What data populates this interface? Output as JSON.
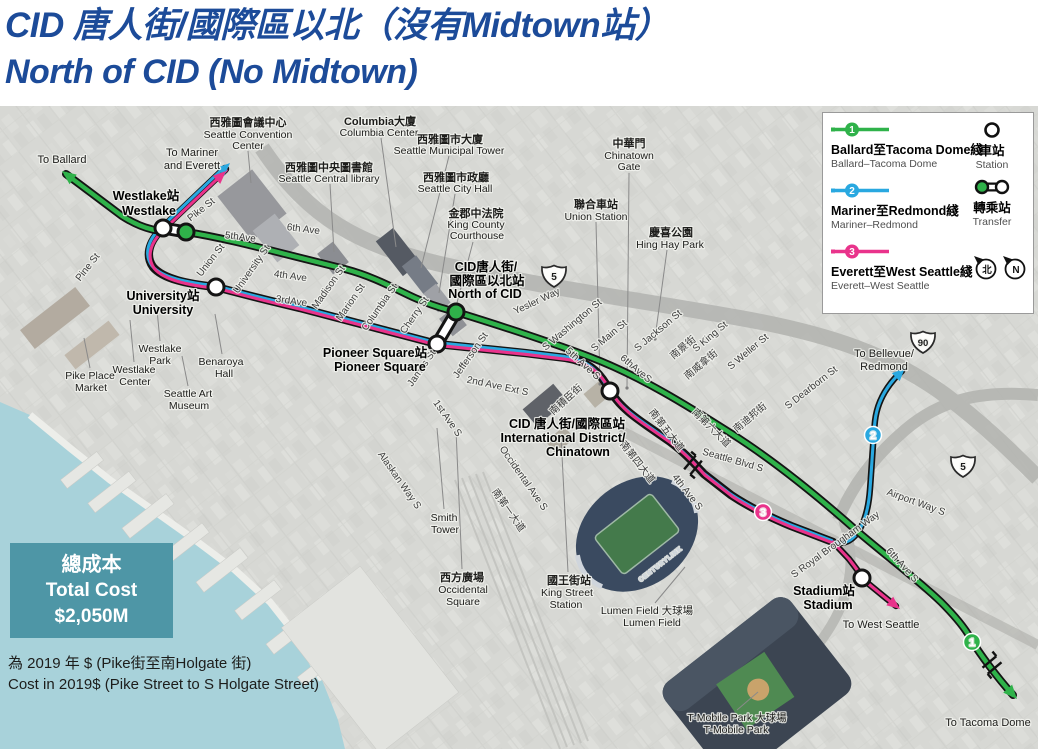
{
  "title": {
    "zh": "CID 唐人街/國際區以北（沒有Midtown站）",
    "en": "North of CID (No Midtown)"
  },
  "colors": {
    "green": "#2fb24a",
    "blue": "#29a8e0",
    "pink": "#e9338b",
    "title_blue": "#1c4b99",
    "cost_teal": "#4e96a6"
  },
  "legend": {
    "lines": [
      {
        "badge": "1",
        "zh": "Ballard至Tacoma Dome綫",
        "en": "Ballard–Tacoma Dome",
        "color": "#2fb24a"
      },
      {
        "badge": "2",
        "zh": "Mariner至Redmond綫",
        "en": "Mariner–Redmond",
        "color": "#29a8e0"
      },
      {
        "badge": "3",
        "zh": "Everett至West Seattle綫",
        "en": "Everett–West Seattle",
        "color": "#e9338b"
      }
    ],
    "station_zh": "車站",
    "station_en": "Station",
    "transfer_zh": "轉乘站",
    "transfer_en": "Transfer",
    "compass_zh": "北",
    "compass_en": "N"
  },
  "cost": {
    "zh": "總成本",
    "en": "Total Cost",
    "value": "$2,050M"
  },
  "footnote": {
    "zh": "為 2019 年 $ (Pike街至南Holgate 街)",
    "en": "Cost in 2019$ (Pike Street to S Holgate Street)"
  },
  "map": {
    "destinations": {
      "ballard": "To Ballard",
      "mariner1": "To Mariner",
      "mariner2": "and Everett",
      "bellevue1": "To Bellevue/",
      "bellevue2": "Redmond",
      "west_seattle": "To West Seattle",
      "tacoma": "To Tacoma Dome"
    },
    "stations": {
      "westlake_zh": "Westlake站",
      "westlake_en": "Westlake",
      "university_zh": "University站",
      "university_en": "University",
      "north_cid_1": "CID唐人街/",
      "north_cid_2": "國際區以北站",
      "north_cid_3": "North of CID",
      "pioneer_zh": "Pioneer Square站",
      "pioneer_en": "Pioneer Square",
      "cid_1": "CID 唐人街/國際區站",
      "cid_2": "International District/",
      "cid_3": "Chinatown",
      "stadium_zh": "Stadium站",
      "stadium_en": "Stadium"
    },
    "places": {
      "conv1": "西雅圖會議中心",
      "conv2": "Seattle Convention",
      "conv3": "Center",
      "lib1": "西雅圖中央圖書館",
      "lib2": "Seattle Central library",
      "col1": "Columbia大廈",
      "col2": "Columbia Center",
      "mun1": "西雅圖市大廈",
      "mun2": "Seattle Municipal Tower",
      "hall1": "西雅圖市政廳",
      "hall2": "Seattle City Hall",
      "court1": "金郡中法院",
      "court2": "King County",
      "court3": "Courthouse",
      "gate1": "中華門",
      "gate2": "Chinatown",
      "gate3": "Gate",
      "union1": "聯合車站",
      "union2": "Union Station",
      "hing1": "慶喜公園",
      "hing2": "Hing Hay Park",
      "wpark1": "Westlake",
      "wpark2": "Park",
      "ben1": "Benaroya",
      "ben2": "Hall",
      "pike1": "Pike Place",
      "pike2": "Market",
      "wcen1": "Westlake",
      "wcen2": "Center",
      "sam1": "Seattle Art",
      "sam2": "Museum",
      "smith1": "Smith",
      "smith2": "Tower",
      "occ1": "西方廣場",
      "occ2": "Occidental",
      "occ3": "Square",
      "king1": "國王街站",
      "king2": "King Street",
      "king3": "Station",
      "lumen1": "Lumen Field 大球場",
      "lumen2": "Lumen Field",
      "tmob1": "T-Mobile Park 大球場",
      "tmob2": "T-Mobile Park"
    },
    "streets": {
      "pike": "Pike St",
      "pine": "Pine St",
      "union_st": "Union St",
      "univ": "University St",
      "ave5": "5thAve",
      "ave6": "6th Ave",
      "ave4": "4th Ave",
      "ave3": "3rdAve",
      "madison": "Madison St",
      "marion": "Marion St",
      "columbia": "Columbia St",
      "cherry": "Cherry St",
      "james": "James St",
      "jefferson": "Jefferson St",
      "ave1s": "1st Ave S",
      "ave2ext": "2nd Ave Ext S",
      "yesler": "Yesler Way",
      "swash": "S Washington St",
      "smain": "S Main St",
      "sjackson": "S Jackson St",
      "sjackson_zh": "南積臣街",
      "sking": "S King St",
      "sking_zh": "南景街",
      "sweller": "S Weller St",
      "sweller_zh": "南威拿街",
      "sdearborn": "S Dearborn St",
      "sdearborn_zh": "南迪邦街",
      "ave6s_zh": "南第六大道",
      "ave6s_line": "6thAveS",
      "ave5s": "5th Ave S",
      "ave5s_zh": "南第五大道",
      "ave4s_zh": "南第四大道",
      "ave4s": "4th Ave S",
      "seattle_blvd": "Seattle Blvd S",
      "occidental": "Occidental Ave S",
      "ave1s_zh": "南第一大道",
      "alaskan": "Alaskan Way S",
      "royal": "S Royal Brougham Way",
      "ave6s2": "6th Ave S",
      "airport": "Airport Way S"
    },
    "badges": {
      "b1": "1",
      "b2": "2",
      "b3": "3"
    },
    "shields": {
      "i5": "5",
      "i90": "90",
      "i5b": "5"
    },
    "lumen_roof": "CENTURYLINK"
  }
}
